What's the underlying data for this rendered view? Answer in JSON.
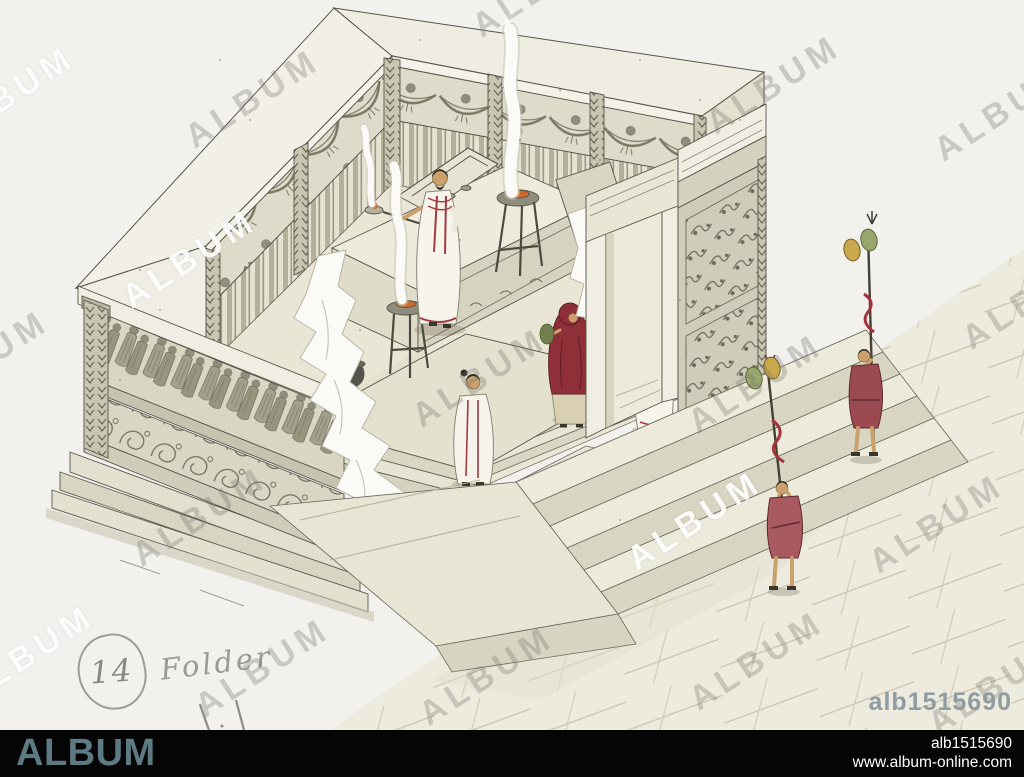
{
  "watermark_text": "ALBUM",
  "image_id": "alb1515690",
  "footer": {
    "brand": "ALBUM",
    "image_id": "alb1515690",
    "website": "www.album-online.com"
  },
  "annotations": {
    "circled_number": "14",
    "word": "Folder"
  },
  "illustration": {
    "subject": "roman-altar-reconstruction-drawing",
    "colors": {
      "paper": "#f2f1ee",
      "stone_light": "#f0eee3",
      "stone_mid": "#d9d6c3",
      "stone_shadow": "#c6c3ae",
      "line": "#57554b",
      "figure_red": "#8f3038",
      "tunic_red": "#9c4a52",
      "skin": "#caa06c",
      "disc_gold": "#c9a84c",
      "disc_green": "#98a66c",
      "accent_slate": "#5d7a82"
    }
  },
  "watermarks": [
    {
      "x": 8,
      "y": 96,
      "color": "white"
    },
    {
      "x": 253,
      "y": 99,
      "color": "gray"
    },
    {
      "x": 540,
      "y": -12,
      "color": "gray"
    },
    {
      "x": 774,
      "y": 85,
      "color": "gray"
    },
    {
      "x": 1002,
      "y": 112,
      "color": "gray"
    },
    {
      "x": 190,
      "y": 259,
      "color": "white"
    },
    {
      "x": -18,
      "y": 360,
      "color": "gray"
    },
    {
      "x": 480,
      "y": 378,
      "color": "gray"
    },
    {
      "x": 756,
      "y": 384,
      "color": "gray"
    },
    {
      "x": 1030,
      "y": 300,
      "color": "gray"
    },
    {
      "x": 200,
      "y": 517,
      "color": "gray"
    },
    {
      "x": 695,
      "y": 521,
      "color": "white"
    },
    {
      "x": 937,
      "y": 524,
      "color": "gray"
    },
    {
      "x": 28,
      "y": 655,
      "color": "white"
    },
    {
      "x": 263,
      "y": 668,
      "color": "gray"
    },
    {
      "x": 487,
      "y": 676,
      "color": "gray"
    },
    {
      "x": 757,
      "y": 661,
      "color": "gray"
    },
    {
      "x": 996,
      "y": 686,
      "color": "gray"
    }
  ]
}
